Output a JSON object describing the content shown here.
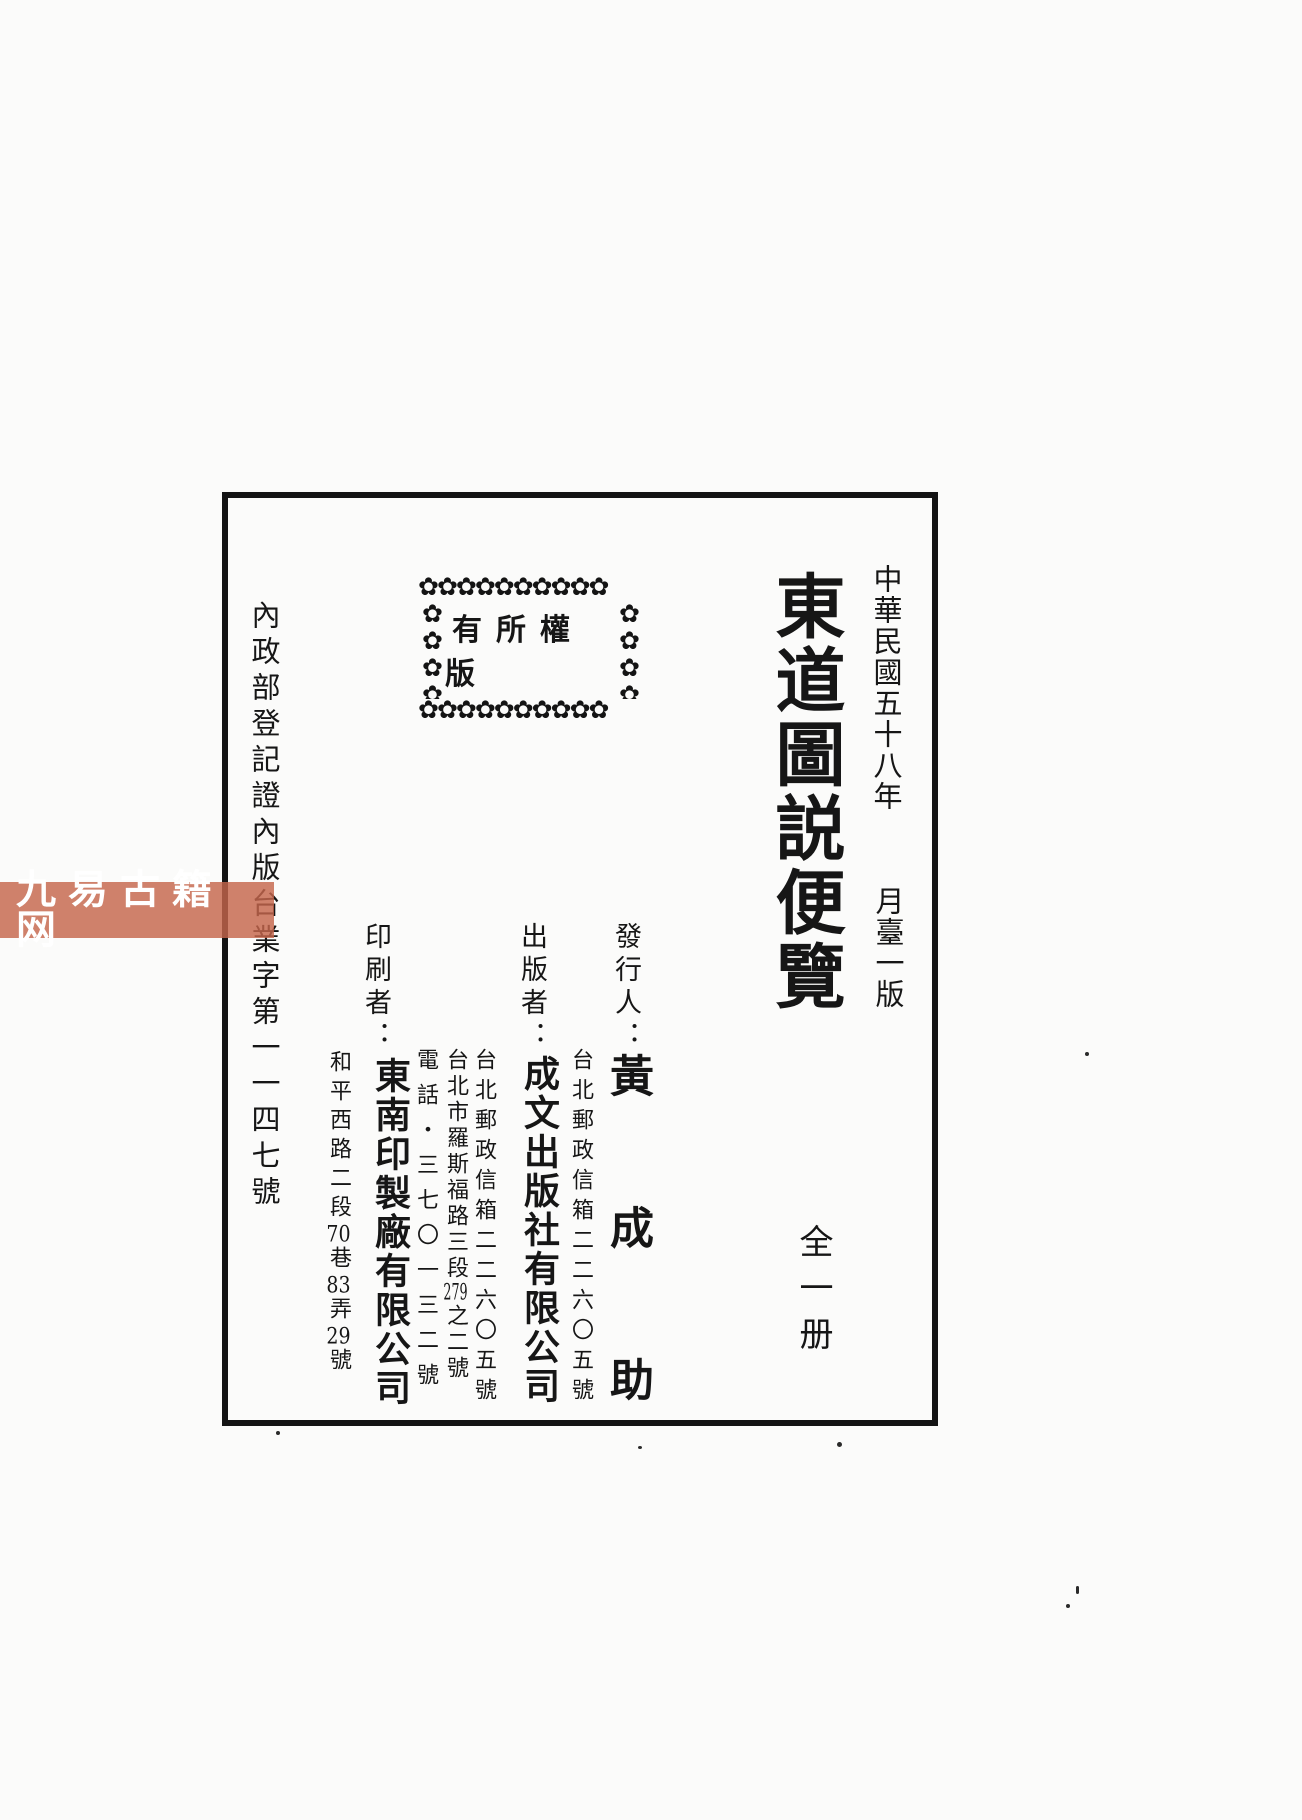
{
  "document": {
    "era_date": "中華民國五十八年",
    "edition": "月臺一版",
    "title": "東道圖説便覽",
    "volume": "全一册",
    "registration": "內政部登記證內版台業字第一一四七號",
    "stamp_text": "有所權版",
    "issuer": {
      "label": "發行人：",
      "name": "黃成助",
      "address": "台北郵政信箱二二六〇五號"
    },
    "publisher": {
      "label": "出版者：",
      "name": "成文出版社有限公司",
      "po_box": "台北郵政信箱二二六〇五號",
      "street_parts": [
        "台北市羅斯福路三段",
        "279",
        "之二號"
      ],
      "phone": "電話・三七〇一三二號"
    },
    "printer": {
      "label": "印刷者：",
      "name": "東南印製廠有限公司",
      "address_parts": [
        "和平西路二段",
        "70",
        "巷",
        "83",
        "弄",
        "29",
        "號"
      ]
    },
    "watermark": "九易古籍网",
    "colors": {
      "ink": "#161616",
      "watermark_bg": "#c5654c",
      "watermark_text": "#ffffff"
    }
  }
}
